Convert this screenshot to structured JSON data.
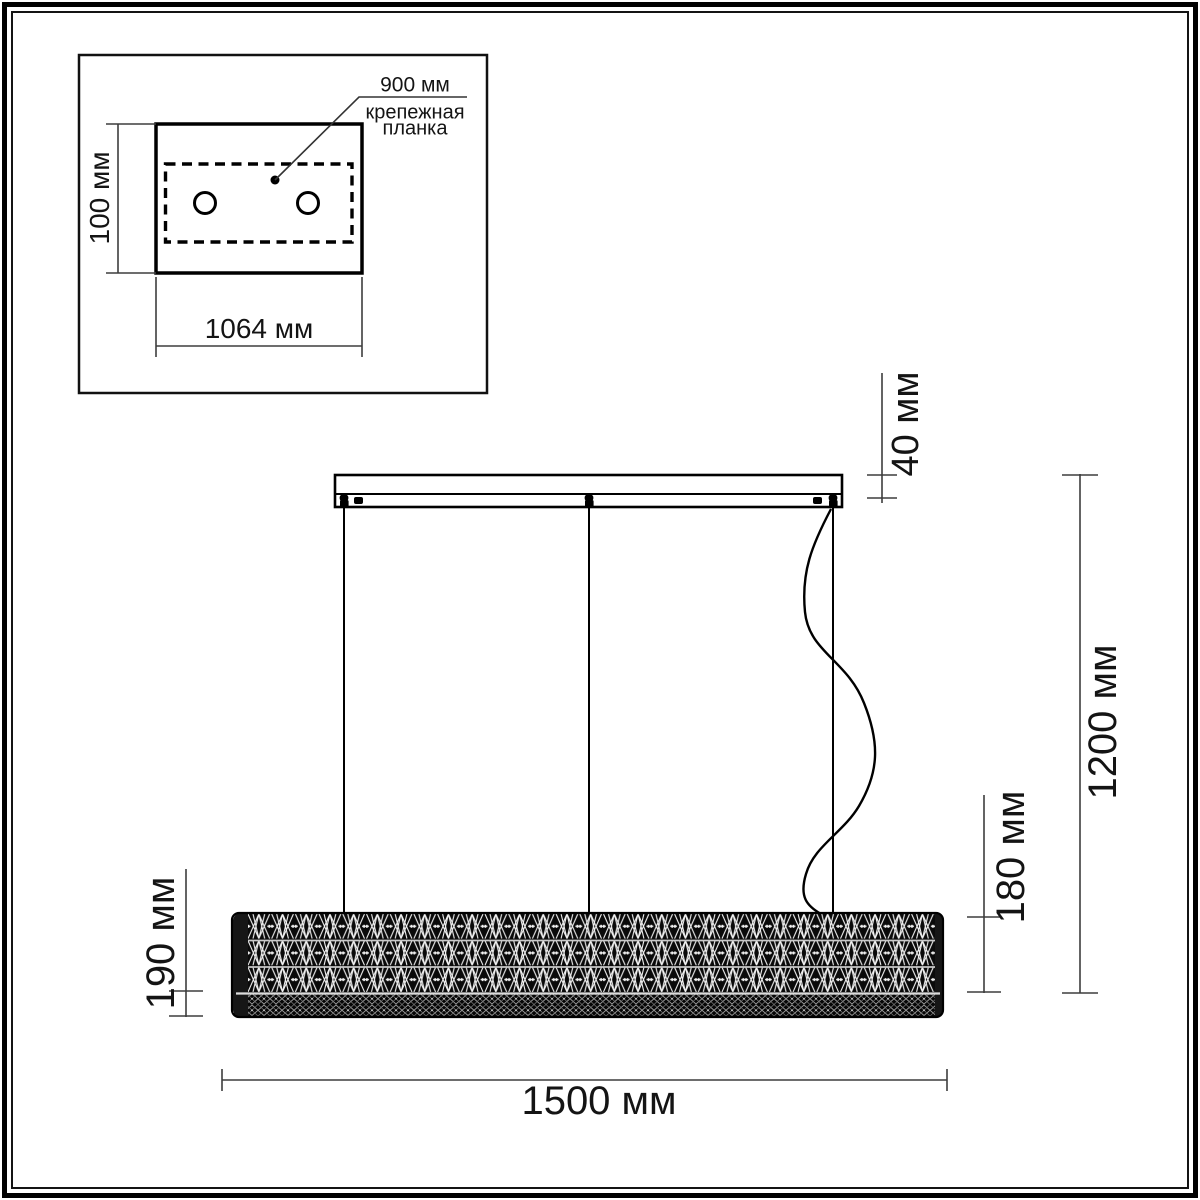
{
  "drawing_type": "pendant chandelier installation dimensions",
  "inset": {
    "mount_bar": {
      "length_label": "900 мм",
      "name_line1": "крепежная",
      "name_line2": "планка"
    },
    "plate_height_label": "100 мм",
    "plate_width_label": "1064 мм"
  },
  "main": {
    "canopy_height_label": "40 мм",
    "overall_height_label": "1200 мм",
    "shade_height_right_label": "180 мм",
    "shade_height_left_label": "190 мм",
    "shade_length_label": "1500 мм"
  },
  "colors": {
    "background": "#ffffff",
    "object_line": "#000000",
    "dimension_line": "#4a4a4a",
    "crystal_dark": "#0a0a0a",
    "crystal_light": "#f2f2f2"
  }
}
